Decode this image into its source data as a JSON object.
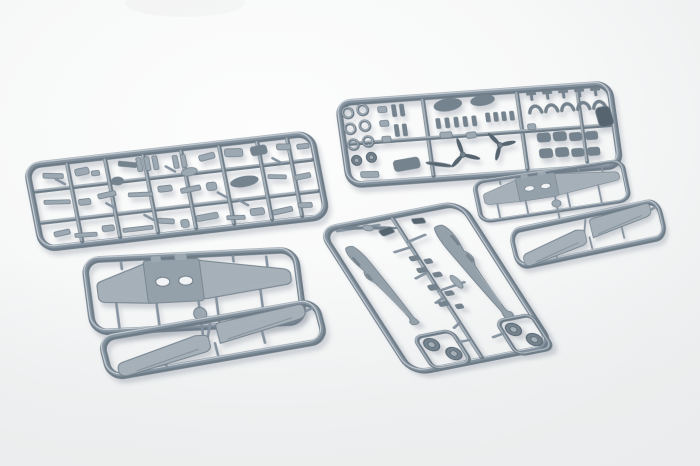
{
  "meta": {
    "description": "Product photograph of gray injection-moulded plastic model aircraft sprues (runner frames with wings, fuselage halves, propellers, wheels, cowlings and many small parts) laid on a white seamless background"
  },
  "scene": {
    "background": {
      "top_left": "#fdfdfd",
      "center": "#f7f8f8",
      "bottom": "#ebedee",
      "vignette": "#e7e9ea"
    },
    "plastic": {
      "runner_dark": "#6e7c88",
      "runner": "#8693a0",
      "runner_light": "#a9b3bb",
      "highlight": "#ccd3d8",
      "part": "#9da9b2",
      "part_dark": "#75838e",
      "darkest": "#55646f",
      "surface": "#a6b0b8",
      "surface_dark": "#95a1aa",
      "hole": "#f2f3f5",
      "shadow": "rgba(120,132,146,0.33)"
    },
    "sprues": [
      {
        "id": "detail-sprue-a",
        "label": "small parts sprue A",
        "kind": "detail_a",
        "matrix": [
          1,
          -0.115,
          0.19,
          0.98,
          22,
          163
        ],
        "w": 292,
        "h": 92
      },
      {
        "id": "detail-sprue-b",
        "label": "small parts sprue B — wheels, propellers, cowlings",
        "kind": "detail_b",
        "matrix": [
          1,
          -0.072,
          0.14,
          0.99,
          334,
          100
        ],
        "w": 278,
        "h": 90
      },
      {
        "id": "lower-wing-sprue-left",
        "label": "one-piece lower wing sprue (first kit)",
        "kind": "wing_lower",
        "matrix": [
          1,
          -0.05,
          0.13,
          0.99,
          80,
          257
        ],
        "w": 218,
        "h": 80
      },
      {
        "id": "upper-wing-sprue-left",
        "label": "upper wing panels sprue (first kit)",
        "kind": "wing_upper",
        "matrix": [
          1,
          -0.175,
          0.25,
          0.96,
          96,
          336
        ],
        "w": 222,
        "h": 48
      },
      {
        "id": "fuselage-sprue",
        "label": "fuselage halves sprue",
        "kind": "fuselage",
        "matrix": [
          0.98,
          -0.193,
          0.54,
          0.843,
          315,
          228
        ],
        "w": 150,
        "h": 177
      },
      {
        "id": "lower-wing-sprue-right",
        "label": "one-piece lower wing sprue (second kit)",
        "kind": "wing_lower",
        "matrix": [
          0.7,
          -0.105,
          0.112,
          0.543,
          471,
          181
        ],
        "w": 218,
        "h": 80
      },
      {
        "id": "upper-wing-sprue-right",
        "label": "upper wing panels sprue (second kit)",
        "kind": "wing_upper",
        "matrix": [
          0.685,
          -0.144,
          0.211,
          0.88,
          507,
          229
        ],
        "w": 222,
        "h": 48
      }
    ]
  }
}
